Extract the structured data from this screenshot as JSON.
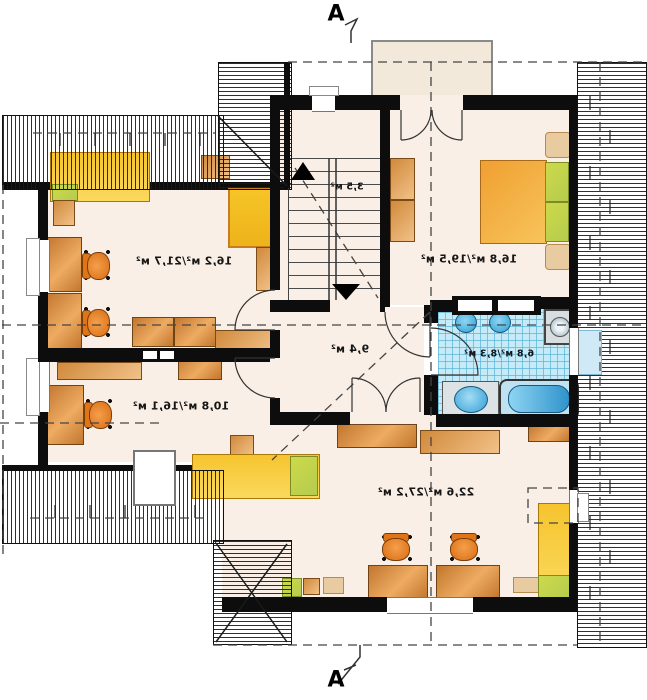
{
  "title": "attic floor plan",
  "section_markers": {
    "top": "A",
    "bottom": "A"
  },
  "rooms": [
    {
      "id": "room-top-left",
      "area_label": "16,2 м²/21,7 м²",
      "furniture": [
        "bed",
        "nightstand",
        "two-desks",
        "two-office-chairs",
        "tall-wardrobe",
        "cabinets"
      ]
    },
    {
      "id": "room-bottom-left",
      "area_label": "10,8 м²/16,1 м²",
      "furniture": [
        "desk",
        "office-chair",
        "shelf",
        "dresser",
        "bed-under-roof",
        "roof-window"
      ]
    },
    {
      "id": "bedroom-top-right",
      "area_label": "16,8 м²/19,5 м²",
      "furniture": [
        "double-bed",
        "two-nightstands",
        "wardrobe"
      ]
    },
    {
      "id": "bathroom",
      "area_label": "6,8 м²/8,3 м²",
      "furniture": [
        "toilet",
        "bidet",
        "washing-machine",
        "washbasin",
        "bathtub"
      ]
    },
    {
      "id": "hall",
      "area_label": "9,4 м²",
      "furniture": []
    },
    {
      "id": "staircase",
      "area_label": "3,5 м²",
      "furniture": [
        "stairs-up-arrow",
        "stairs-down-arrow"
      ]
    },
    {
      "id": "room-bottom",
      "area_label": "22,6 м²/27,2 м²",
      "furniture": [
        "two-desks",
        "two-office-chairs",
        "bed",
        "cabinets",
        "roof-window"
      ]
    }
  ],
  "colors": {
    "floor": "#f9efe6",
    "wall": "#0d0d0d",
    "wood_furniture": "#d9873a",
    "bed_yellow": "#f6c42e",
    "pillow_green": "#c6d44e",
    "chair_orange": "#e87a20",
    "bath_tile": "#c6ebf8",
    "fixture_blue": "#3aa5d9",
    "balcony": "#f3e9da",
    "dashed_line": "#444444"
  },
  "notes": {
    "text_mirrored": "all area labels appear horizontally mirrored"
  }
}
